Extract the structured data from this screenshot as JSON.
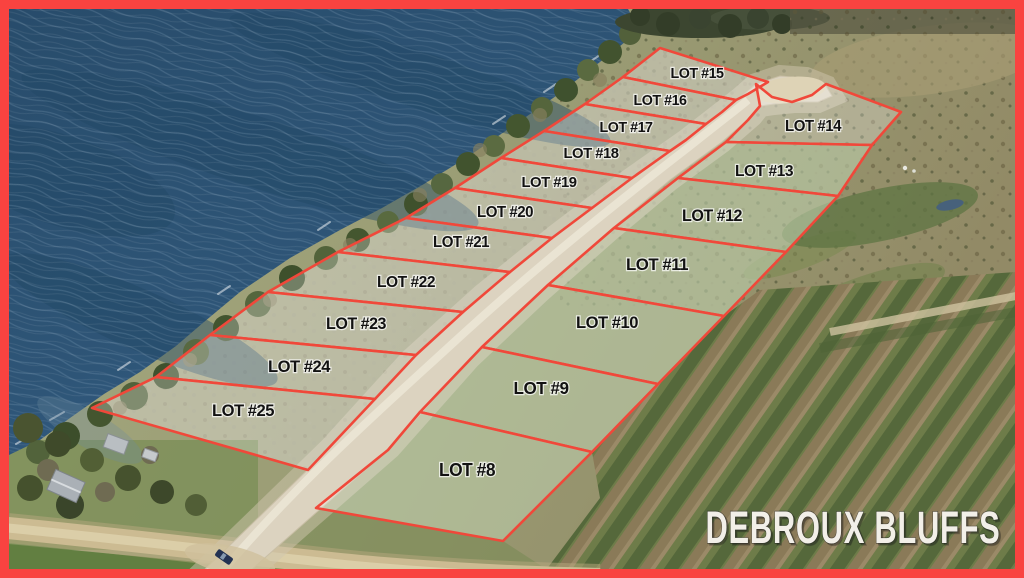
{
  "watermark": {
    "text": "DEBROUX BLUFFS"
  },
  "colors": {
    "frame": "#f94340",
    "lot_line": "#f0483a",
    "lot_fill": "rgba(255,255,255,0.27)",
    "label_text": "#121212",
    "watermark_text": "#f2efe8"
  },
  "lots": [
    {
      "id": 15,
      "label": "LOT #15",
      "lx": 697,
      "ly": 78,
      "fs": 14.5,
      "points": "660,48 768,82 748,94 736,100 623,77"
    },
    {
      "id": 16,
      "label": "LOT #16",
      "lx": 660,
      "ly": 105,
      "fs": 14.5,
      "points": "623,77 736,100 722,112 706,124 585,104"
    },
    {
      "id": 17,
      "label": "LOT #17",
      "lx": 626,
      "ly": 132,
      "fs": 14.5,
      "points": "585,104 706,124 686,140 670,151 544,131"
    },
    {
      "id": 18,
      "label": "LOT #18",
      "lx": 591,
      "ly": 158,
      "fs": 15,
      "points": "544,131 670,151 632,178 501,158"
    },
    {
      "id": 19,
      "label": "LOT #19",
      "lx": 549,
      "ly": 187,
      "fs": 15,
      "points": "501,158 632,178 592,208 455,188"
    },
    {
      "id": 20,
      "label": "LOT #20",
      "lx": 505,
      "ly": 217,
      "fs": 15.5,
      "points": "455,188 592,208 552,238 406,218"
    },
    {
      "id": 21,
      "label": "LOT #21",
      "lx": 461,
      "ly": 247,
      "fs": 15.5,
      "points": "406,218 552,238 510,272 338,252"
    },
    {
      "id": 22,
      "label": "LOT #22",
      "lx": 406,
      "ly": 287,
      "fs": 16,
      "points": "338,252 510,272 463,312 268,292"
    },
    {
      "id": 23,
      "label": "LOT #23",
      "lx": 356,
      "ly": 329,
      "fs": 16.5,
      "points": "268,292 463,312 416,355 210,335"
    },
    {
      "id": 24,
      "label": "LOT #24",
      "lx": 299,
      "ly": 372,
      "fs": 17,
      "points": "210,335 416,355 375,399 156,377"
    },
    {
      "id": 25,
      "label": "LOT #25",
      "lx": 243,
      "ly": 416,
      "fs": 17,
      "points": "156,377 375,399 308,470 92,408"
    },
    {
      "id": 14,
      "label": "LOT #14",
      "lx": 813,
      "ly": 131,
      "fs": 15.5,
      "points": "756,84 772,97 792,102 812,95 826,84 901,112 872,145 726,142 748,120 760,106"
    },
    {
      "id": 13,
      "label": "LOT #13",
      "lx": 764,
      "ly": 176,
      "fs": 16,
      "points": "726,142 872,145 838,196 678,178"
    },
    {
      "id": 12,
      "label": "LOT #12",
      "lx": 712,
      "ly": 221,
      "fs": 16.5,
      "points": "678,178 838,196 786,252 614,228"
    },
    {
      "id": 11,
      "label": "LOT #11",
      "lx": 657,
      "ly": 270,
      "fs": 17,
      "points": "614,228 786,252 724,316 548,285"
    },
    {
      "id": 10,
      "label": "LOT #10",
      "lx": 607,
      "ly": 328,
      "fs": 17,
      "points": "548,285 724,316 658,384 482,347"
    },
    {
      "id": 9,
      "label": "LOT #9",
      "lx": 541,
      "ly": 394,
      "fs": 17.5,
      "points": "482,347 658,384 592,452 420,412"
    },
    {
      "id": 8,
      "label": "LOT #8",
      "lx": 467,
      "ly": 476,
      "fs": 18,
      "points": "420,412 592,452 503,541 316,508 388,450"
    }
  ]
}
